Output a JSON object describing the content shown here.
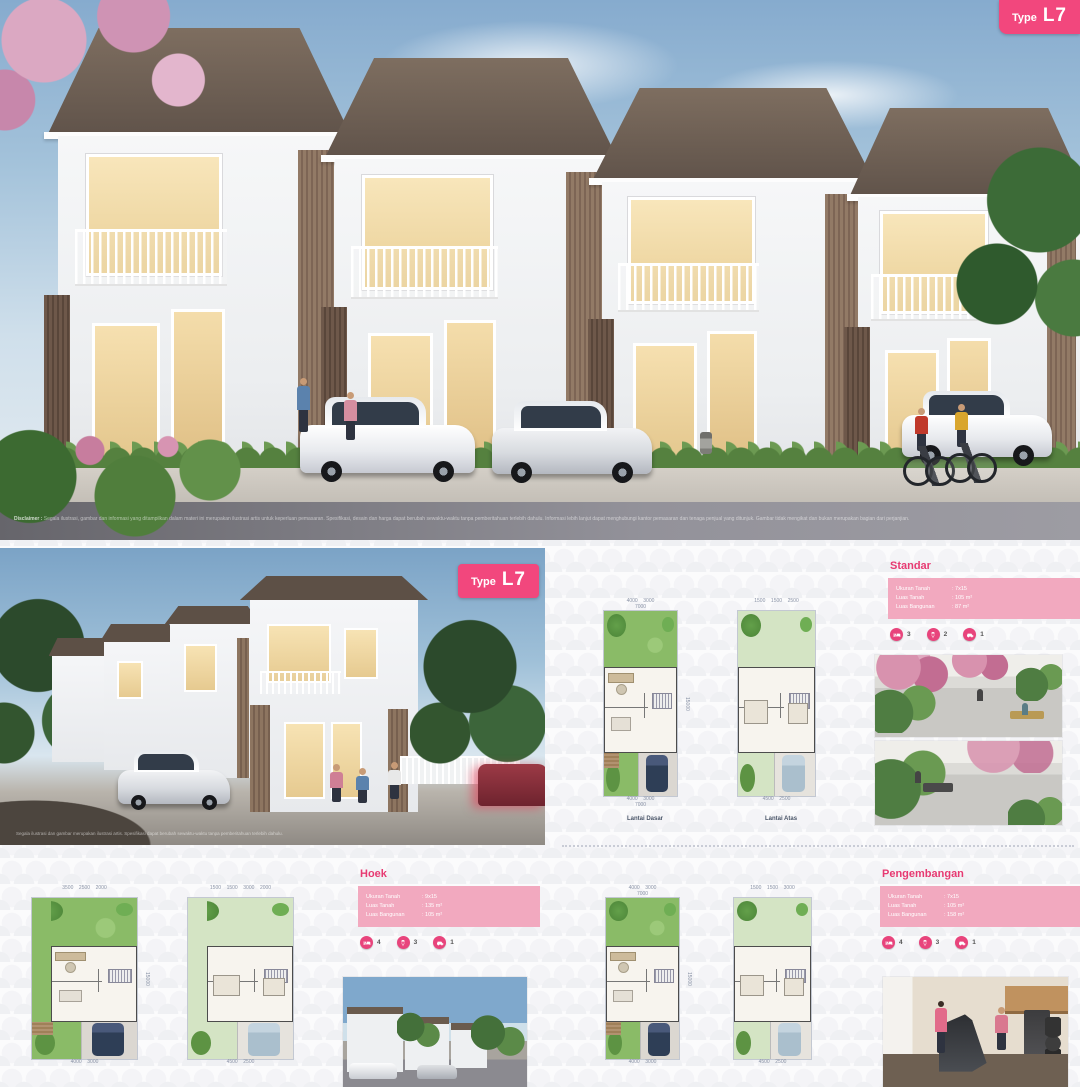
{
  "watermark": "N",
  "hero": {
    "badge": {
      "prefix": "Type",
      "code": "L7"
    },
    "disclaimer_label": "Disclaimer :",
    "disclaimer_text": "Segala ilustrasi, gambar dan informasi yang ditampilkan dalam materi ini merupakan ilustrasi artis untuk keperluan pemasaran. Spesifikasi, desain dan harga dapat berubah sewaktu-waktu tanpa pemberitahuan terlebih dahulu. Informasi lebih lanjut dapat menghubungi kantor pemasaran dan tenaga penjual yang ditunjuk. Gambar tidak mengikat dan bukan merupakan bagian dari perjanjian."
  },
  "render": {
    "badge": {
      "prefix": "Type",
      "code": "L7"
    },
    "disclaimer_text": "Segala ilustrasi dan gambar merupakan ilustrasi artis. Spesifikasi dapat berubah sewaktu-waktu tanpa pemberitahuan terlebih dahulu."
  },
  "sections": {
    "standar": {
      "title": "Standar",
      "specs": [
        {
          "label": "Ukuran Tanah",
          "value": ": 7x15"
        },
        {
          "label": "Luas Tanah",
          "value": ": 105 m²"
        },
        {
          "label": "Luas Bangunan",
          "value": ": 87 m²"
        }
      ],
      "features": [
        {
          "icon": "bed-icon",
          "count": "3"
        },
        {
          "icon": "shower-icon",
          "count": "2"
        },
        {
          "icon": "car-icon",
          "count": "1"
        }
      ]
    },
    "hoek": {
      "title": "Hoek",
      "specs": [
        {
          "label": "Ukuran Tanah",
          "value": ": 9x15"
        },
        {
          "label": "Luas Tanah",
          "value": ": 135 m²"
        },
        {
          "label": "Luas Bangunan",
          "value": ": 105 m²"
        }
      ],
      "features": [
        {
          "icon": "bed-icon",
          "count": "4"
        },
        {
          "icon": "shower-icon",
          "count": "3"
        },
        {
          "icon": "car-icon",
          "count": "1"
        }
      ]
    },
    "pengembangan": {
      "title": "Pengembangan",
      "specs": [
        {
          "label": "Ukuran Tanah",
          "value": ": 7x15"
        },
        {
          "label": "Luas Tanah",
          "value": ": 105 m²"
        },
        {
          "label": "Luas Bangunan",
          "value": ": 158 m²"
        }
      ],
      "features": [
        {
          "icon": "bed-icon",
          "count": "4"
        },
        {
          "icon": "shower-icon",
          "count": "3"
        },
        {
          "icon": "car-icon",
          "count": "1"
        }
      ]
    }
  },
  "floorplans": {
    "standar_ground": {
      "variant": "ground",
      "wide": false,
      "label": "Lantai Dasar",
      "top_dims": [
        "4000",
        "3000"
      ],
      "top_total": "7000",
      "bottom_dims": [
        "4000",
        "3000"
      ],
      "bottom_total": "7000",
      "side_total": "15000"
    },
    "standar_upper": {
      "variant": "upper",
      "wide": false,
      "label": "Lantai Atas",
      "top_dims": [
        "1500",
        "1500",
        "2500"
      ],
      "bottom_dims": [
        "4500",
        "2500"
      ]
    },
    "hoek_ground": {
      "variant": "ground",
      "wide": true,
      "top_dims": [
        "3500",
        "2500",
        "2000"
      ],
      "bottom_dims": [
        "4000",
        "3000"
      ],
      "side_total": "15000"
    },
    "hoek_upper": {
      "variant": "upper",
      "wide": true,
      "top_dims": [
        "1500",
        "1500",
        "3000",
        "2000"
      ],
      "bottom_dims": [
        "4500",
        "2500"
      ]
    },
    "pengembangan_ground": {
      "variant": "ground",
      "wide": false,
      "top_dims": [
        "4000",
        "3000"
      ],
      "top_total": "7000",
      "bottom_dims": [
        "4000",
        "3000"
      ],
      "side_total": "15000"
    },
    "pengembangan_upper": {
      "variant": "upper",
      "wide": false,
      "top_dims": [
        "1500",
        "1500",
        "3000"
      ],
      "bottom_dims": [
        "4500",
        "2500"
      ]
    }
  }
}
